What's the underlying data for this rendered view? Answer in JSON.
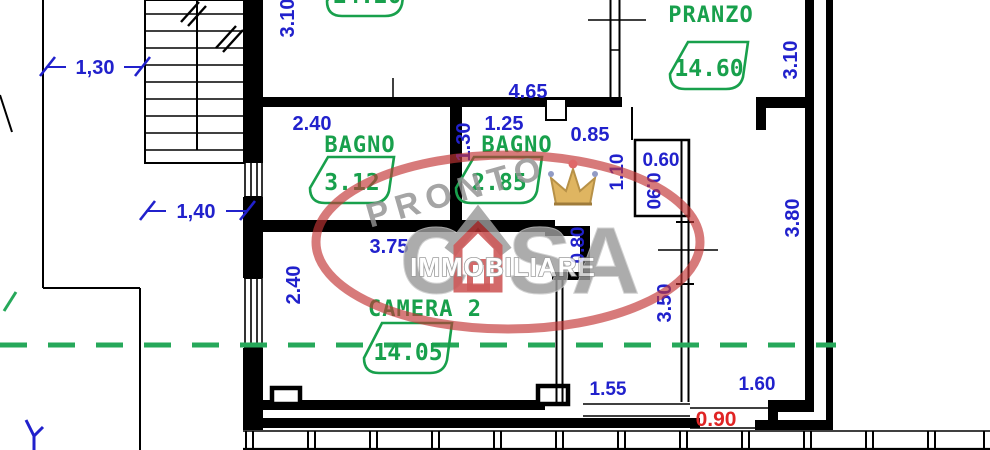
{
  "rooms": [
    {
      "label": "",
      "area": "14.20"
    },
    {
      "label": "PRANZO",
      "area": "14.60"
    },
    {
      "label": "BAGNO",
      "area": "3.12"
    },
    {
      "label": "BAGNO",
      "area": "2.85"
    },
    {
      "label": "CAMERA 2",
      "area": "14.05"
    }
  ],
  "dimensions": {
    "stairs_width": "1,30",
    "top_room_height": "3.10",
    "hall_width": "4.65",
    "bagno1_width": "2.40",
    "bagno2_width": "1.25",
    "bagno2_height": "1.30",
    "entry_width": "0.85",
    "niche_width": "0.60",
    "entry_height": "1.10",
    "niche_height": "0.90",
    "landing_width": "1,40",
    "camera2_width": "3.75",
    "camera2_height_left": "2.40",
    "camera2_door": "0.80",
    "corridor_height": "3.50",
    "ingresso_height": "3.80",
    "pranzo_height": "3.10",
    "balcony_span_left": "1.55",
    "balcony_span_right": "1.60",
    "balcony_door": "0.90"
  },
  "watermark": {
    "top_text": "PRONTO",
    "brand_left": "C",
    "brand_right": "SA",
    "bottom_text": "IMMOBILIARE"
  },
  "colors": {
    "dimension_blue": "#2121cc",
    "label_green": "#18a04c",
    "dashed_green": "#26a85a",
    "red_dimension": "#e02424",
    "watermark_gray": "#9b9b9b",
    "watermark_red": "#c33636",
    "crown_gold": "#d9a53f"
  }
}
